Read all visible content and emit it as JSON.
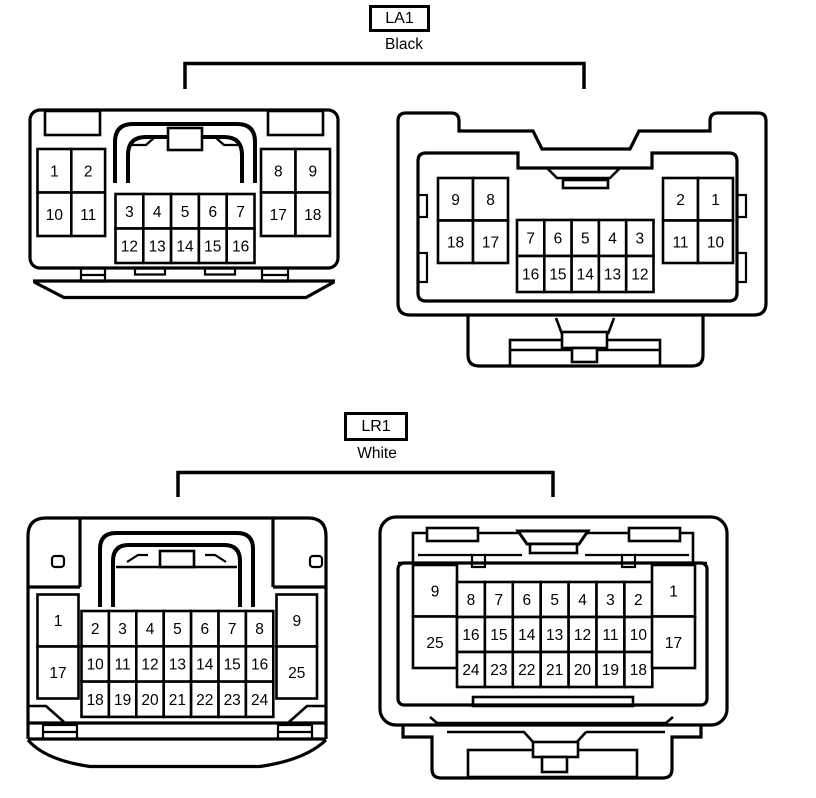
{
  "diagram": {
    "background_color": "#ffffff",
    "line_color": "#000000"
  },
  "groups": [
    {
      "code": "LA1",
      "color_label": "Black",
      "connectors": [
        {
          "name": "la1-harness-side-view",
          "svg_group": "pins-a",
          "blocks": [
            {
              "x": 37.5,
              "y": 149,
              "cw": 33.8,
              "ch": 43.5,
              "rows": [
                [
                  "1",
                  "2"
                ],
                [
                  "10",
                  "11"
                ]
              ]
            },
            {
              "x": 115.5,
              "y": 194,
              "cw": 27.8,
              "ch": 34.5,
              "rows": [
                [
                  "3",
                  "4",
                  "5",
                  "6",
                  "7"
                ],
                [
                  "12",
                  "13",
                  "14",
                  "15",
                  "16"
                ]
              ]
            },
            {
              "x": 261,
              "y": 149,
              "cw": 34.5,
              "ch": 43.5,
              "rows": [
                [
                  "8",
                  "9"
                ],
                [
                  "17",
                  "18"
                ]
              ]
            }
          ]
        },
        {
          "name": "la1-component-side-view",
          "svg_group": "pins-b",
          "blocks": [
            {
              "x": 438,
              "y": 178,
              "cw": 35,
              "ch": 42.5,
              "rows": [
                [
                  "9",
                  "8"
                ],
                [
                  "18",
                  "17"
                ]
              ]
            },
            {
              "x": 517,
              "y": 220,
              "cw": 27.3,
              "ch": 36,
              "rows": [
                [
                  "7",
                  "6",
                  "5",
                  "4",
                  "3"
                ],
                [
                  "16",
                  "15",
                  "14",
                  "13",
                  "12"
                ]
              ]
            },
            {
              "x": 663,
              "y": 178,
              "cw": 35,
              "ch": 42.5,
              "rows": [
                [
                  "2",
                  "1"
                ],
                [
                  "11",
                  "10"
                ]
              ]
            }
          ]
        }
      ]
    },
    {
      "code": "LR1",
      "color_label": "White",
      "connectors": [
        {
          "name": "lr1-harness-side-view",
          "svg_group": "pins-c",
          "blocks": [
            {
              "x": 37.5,
              "y": 594.5,
              "cw": 41,
              "ch": 52,
              "rows": [
                [
                  "1"
                ],
                [
                  "17"
                ]
              ]
            },
            {
              "x": 81.5,
              "y": 611,
              "cw": 27.4,
              "ch": 35.3,
              "rows": [
                [
                  "2",
                  "3",
                  "4",
                  "5",
                  "6",
                  "7",
                  "8"
                ],
                [
                  "10",
                  "11",
                  "12",
                  "13",
                  "14",
                  "15",
                  "16"
                ],
                [
                  "18",
                  "19",
                  "20",
                  "21",
                  "22",
                  "23",
                  "24"
                ]
              ]
            },
            {
              "x": 276.5,
              "y": 594.5,
              "cw": 40.5,
              "ch": 52,
              "rows": [
                [
                  "9"
                ],
                [
                  "25"
                ]
              ]
            }
          ]
        },
        {
          "name": "lr1-component-side-view",
          "svg_group": "pins-d",
          "blocks": [
            {
              "x": 413,
              "y": 565,
              "cw": 44,
              "ch": 51.5,
              "rows": [
                [
                  "9"
                ],
                [
                  "25"
                ]
              ]
            },
            {
              "x": 457,
              "y": 582,
              "cw": 27.9,
              "ch": 35,
              "rows": [
                [
                  "8",
                  "7",
                  "6",
                  "5",
                  "4",
                  "3",
                  "2"
                ],
                [
                  "16",
                  "15",
                  "14",
                  "13",
                  "12",
                  "11",
                  "10"
                ],
                [
                  "24",
                  "23",
                  "22",
                  "21",
                  "20",
                  "19",
                  "18"
                ]
              ]
            },
            {
              "x": 652,
              "y": 565,
              "cw": 43,
              "ch": 51.5,
              "rows": [
                [
                  "1"
                ],
                [
                  "17"
                ]
              ]
            }
          ]
        }
      ]
    }
  ]
}
